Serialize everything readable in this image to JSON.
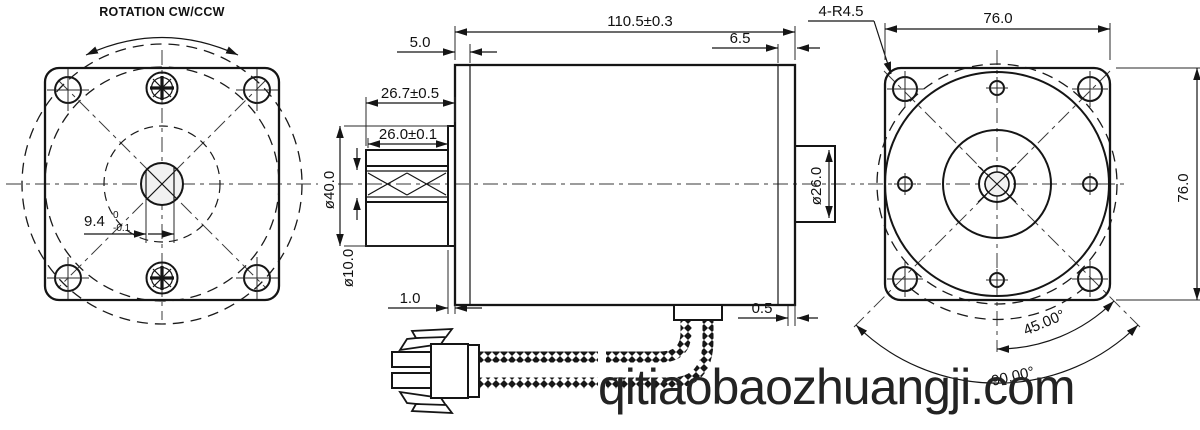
{
  "colors": {
    "line": "#151515",
    "watermark": "#232323",
    "background": "#ffffff"
  },
  "watermark": {
    "text": "qitiaobaozhuangji.com"
  },
  "front_view": {
    "rotation_label": "ROTATION CW/CCW",
    "shaft_flat": {
      "value": "9.4",
      "tol_upper": "0",
      "tol_lower": "-0.1"
    }
  },
  "side_view": {
    "overall_length": "110.5±0.3",
    "front_plate_thickness": "5.0",
    "rear_plate_thickness": "6.5",
    "shaft_length": "26.7±0.5",
    "knurl_length": "26.0±0.1",
    "boss_diameter": "ø40.0",
    "shaft_diameter": "ø10.0",
    "front_step": "1.0",
    "rear_step": "0.5",
    "rear_boss_diameter": "ø26.0"
  },
  "rear_view": {
    "corner_radius": "4-R4.5",
    "width": "76.0",
    "height": "76.0",
    "angle_45": "45.00°",
    "angle_90": "90.00°"
  }
}
